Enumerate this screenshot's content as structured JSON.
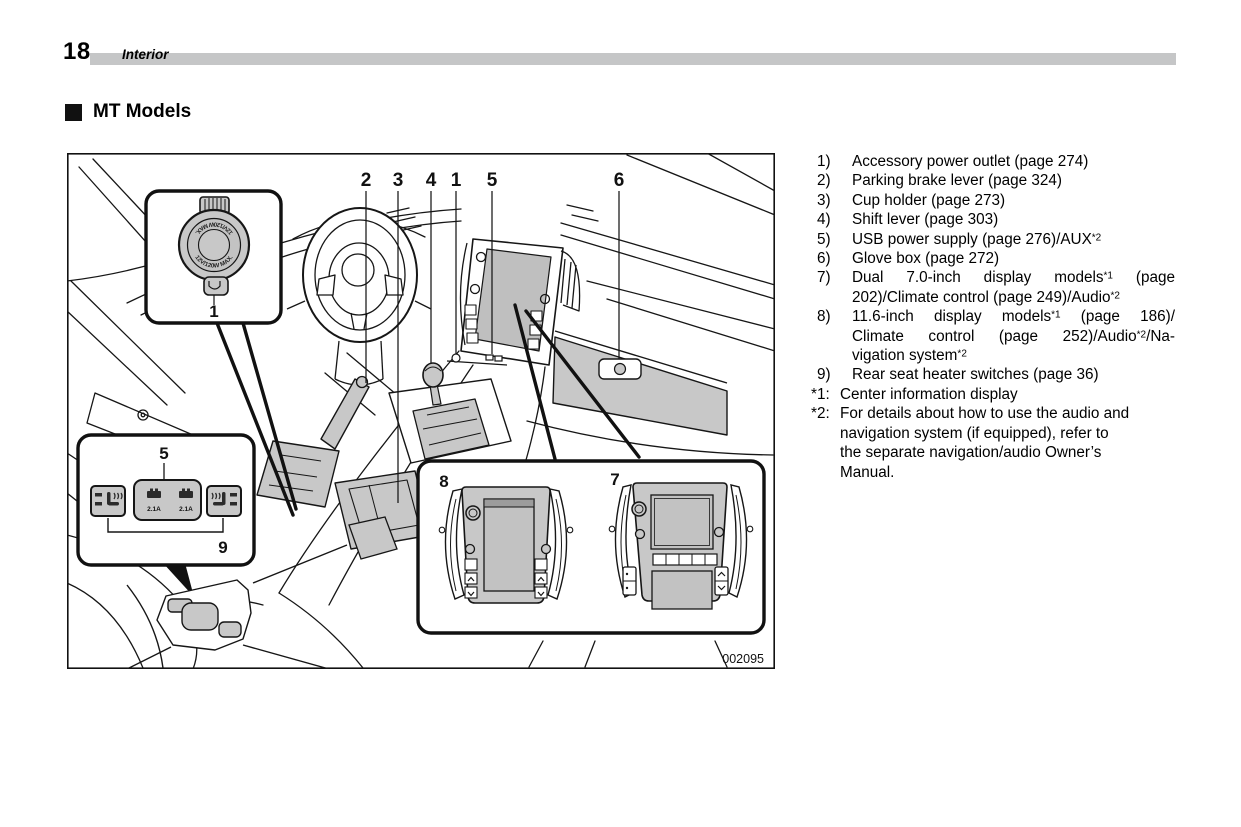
{
  "page": {
    "number": "18",
    "section": "Interior",
    "heading": "MT Models"
  },
  "figure": {
    "code": "002095",
    "callouts": {
      "c1": "1",
      "c2": "2",
      "c3": "3",
      "c4": "4",
      "c5": "5",
      "c6": "6",
      "c7": "7",
      "c8": "8",
      "c9": "9"
    },
    "outlet_ring_text": "12V/120W MAX.",
    "usb_amp": "2.1A"
  },
  "legend": {
    "items": [
      {
        "num": "1)",
        "lines": [
          "Accessory power outlet (page 274)"
        ]
      },
      {
        "num": "2)",
        "lines": [
          "Parking brake lever (page 324)"
        ]
      },
      {
        "num": "3)",
        "lines": [
          "Cup holder (page 273)"
        ]
      },
      {
        "num": "4)",
        "lines": [
          "Shift lever (page 303)"
        ]
      },
      {
        "num": "5)",
        "lines": [
          "USB power supply (page 276)/AUX*2"
        ]
      },
      {
        "num": "6)",
        "lines": [
          "Glove box (page 272)"
        ]
      },
      {
        "num": "7)",
        "lines": [
          "Dual 7.0-inch display models*1 (page",
          "202)/Climate control (page 249)/Audio*2"
        ]
      },
      {
        "num": "8)",
        "lines": [
          "11.6-inch display models*1 (page 186)/",
          "Climate control (page 252)/Audio*2/Na-",
          "vigation system*2"
        ]
      },
      {
        "num": "9)",
        "lines": [
          "Rear seat heater switches (page 36)"
        ]
      }
    ],
    "footnotes": [
      {
        "marker": "*1:",
        "lines": [
          "Center information display"
        ]
      },
      {
        "marker": "*2:",
        "lines": [
          "For details about how to use the audio and",
          "navigation system (if equipped), refer to",
          "the separate navigation/audio Owner’s",
          "Manual."
        ]
      }
    ]
  }
}
